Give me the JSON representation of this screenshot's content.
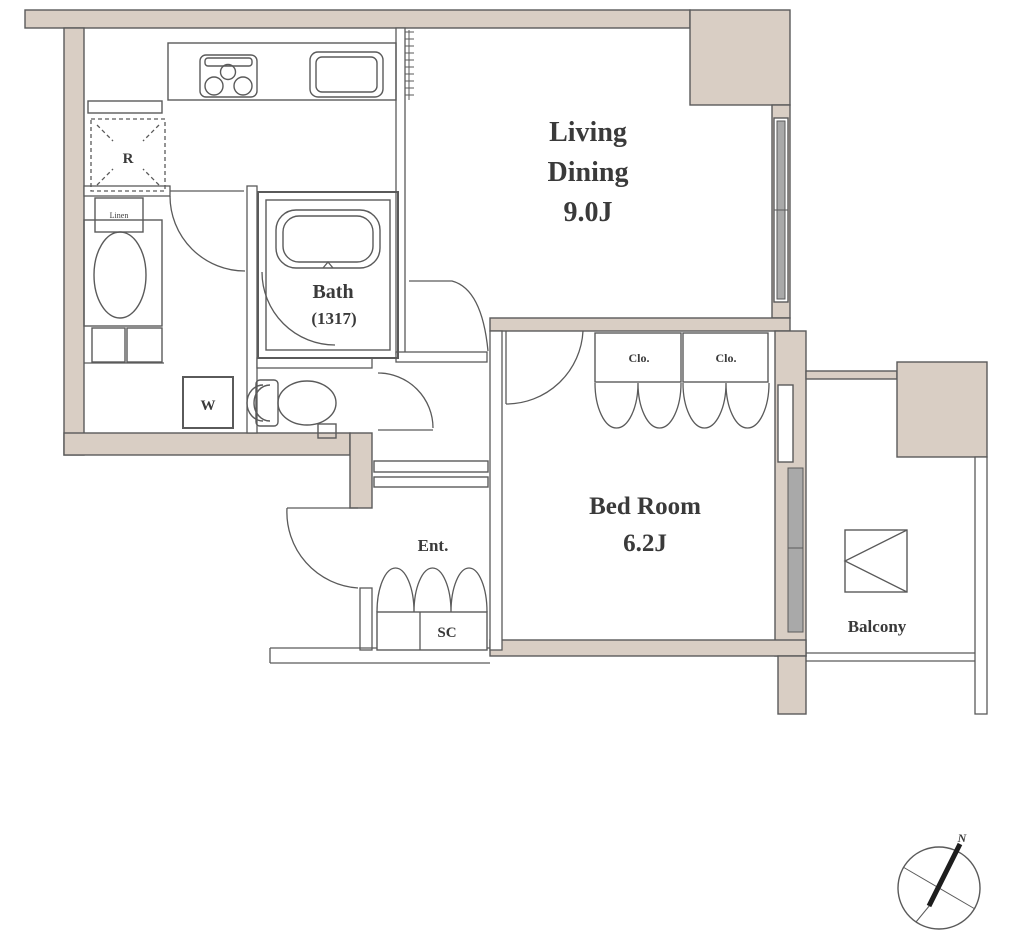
{
  "colors": {
    "wall": "#d9cec4",
    "line": "#5a5a5a",
    "window": "#a9a9a9",
    "text": "#3a3a3a"
  },
  "plan": {
    "living": {
      "line1": "Living",
      "line2": "Dining",
      "size": "9.0J"
    },
    "bedroom": {
      "name": "Bed Room",
      "size": "6.2J"
    },
    "bath": {
      "name": "Bath",
      "size": "(1317)"
    },
    "entrance": {
      "name": "Ent."
    },
    "shoe_closet": {
      "name": "SC"
    },
    "closet_left": {
      "name": "Clo."
    },
    "closet_right": {
      "name": "Clo."
    },
    "balcony": {
      "name": "Balcony"
    },
    "refrigerator": {
      "name": "R"
    },
    "washing_machine": {
      "name": "W"
    },
    "linen": {
      "name": "Linen"
    },
    "compass": {
      "north": "N"
    }
  }
}
